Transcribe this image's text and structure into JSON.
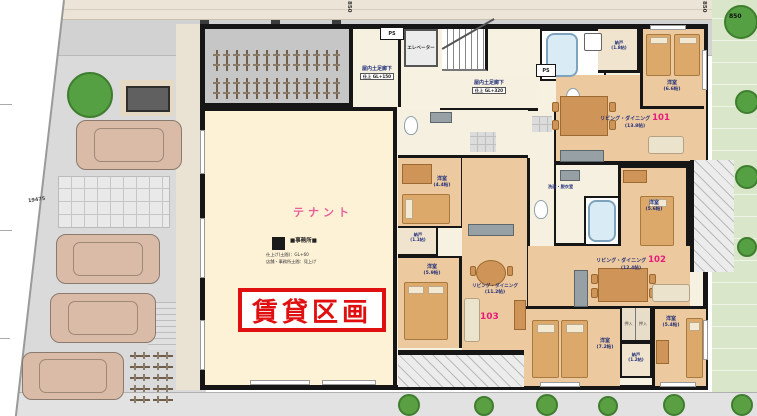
{
  "site": {
    "dims": {
      "top_left": "850",
      "top_right": "850",
      "corner": "850",
      "parking": "19475"
    },
    "bike_rack_top": {
      "rows": 2,
      "per_row": 13
    },
    "bike_rack_left": {
      "rows": 5,
      "cols": 2
    }
  },
  "common": {
    "ps": "PS",
    "elevator": "エレベーター",
    "corridor_left": {
      "label": "屋内土足廊下",
      "finish": "仕上 GL+150"
    },
    "corridor_main": {
      "label": "屋内土足廊下",
      "finish": "仕上 GL+320"
    }
  },
  "services": {
    "washroom": "洗面・脱衣室"
  },
  "tenant": {
    "name": "テナント",
    "office": "■事務所■",
    "note1": "仕上げ(土間)：GL+60",
    "note2": "店舗・事務所土間：見上げ",
    "rental": "賃貸区画"
  },
  "units": {
    "u101": {
      "no": "101",
      "ld_label": "リビング・ダイニング",
      "ld_size": "(13.8帖)",
      "bedroom_label": "洋室",
      "bedroom_size": "(6.6帖)",
      "storage_label": "納戸",
      "storage_size": "(1.8帖)"
    },
    "u102": {
      "no": "102",
      "ld_label": "リビング・ダイニング",
      "ld_size": "(12.4帖)",
      "bedroom1_label": "洋室",
      "bedroom1_size": "(5.6帖)",
      "bedroom2_label": "洋室",
      "bedroom2_size": "(7.2帖)",
      "bedroom3_label": "洋室",
      "bedroom3_size": "(5.4帖)",
      "storage_label": "納戸",
      "storage_size": "(1.2帖)",
      "closet_label": "押入"
    },
    "u103": {
      "no": "103",
      "ld_label": "リビング・ダイニング",
      "ld_size": "(11.2帖)",
      "bedroom1_label": "洋室",
      "bedroom1_size": "(4.4帖)",
      "bedroom2_label": "洋室",
      "bedroom2_size": "(5.9帖)",
      "storage_label": "納戸",
      "storage_size": "(1.1帖)"
    }
  },
  "colors": {
    "unit_number": "#e7197c",
    "tenant_pink": "#e8609a",
    "rental_red": "#e01010",
    "label_navy": "#22307a",
    "wall": "#161616",
    "floor_tan": "#ecc99e"
  }
}
